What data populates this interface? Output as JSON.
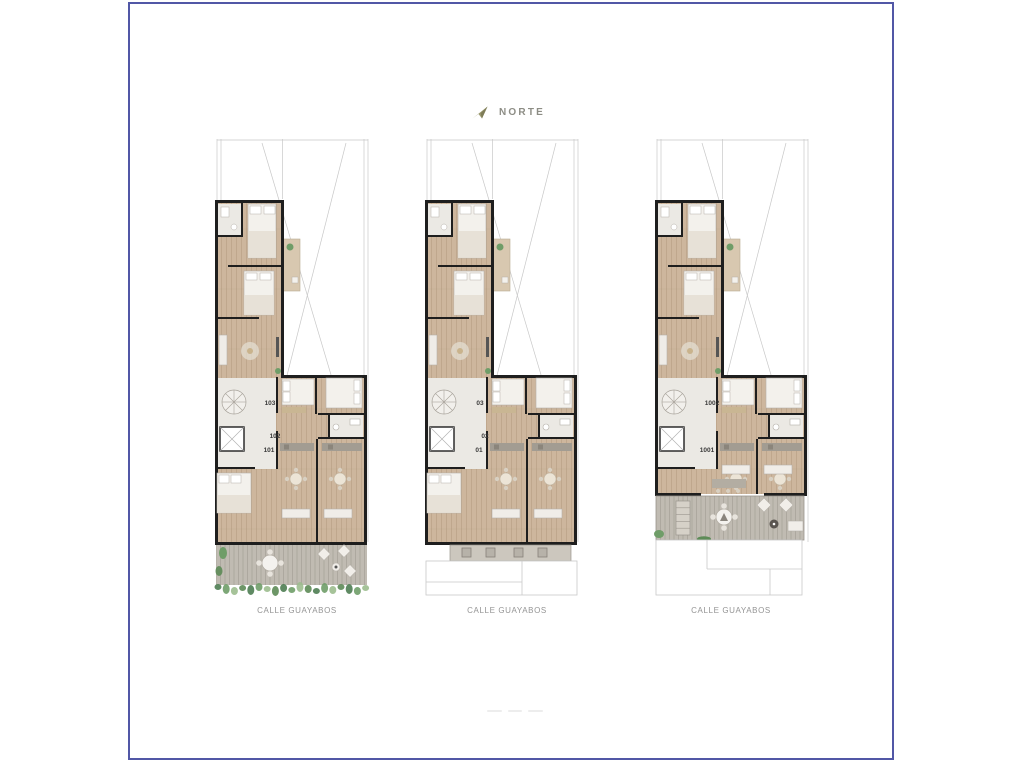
{
  "compass": {
    "label": "NORTE",
    "icon": "north-arrow-icon"
  },
  "plans": [
    {
      "id": "floor-plan-1",
      "street_label": "CALLE GUAYABOS",
      "units": [
        {
          "label": "103"
        },
        {
          "label": "102"
        },
        {
          "label": "101"
        }
      ]
    },
    {
      "id": "floor-plan-2",
      "street_label": "CALLE GUAYABOS",
      "units": [
        {
          "label": "03"
        },
        {
          "label": "02"
        },
        {
          "label": "01"
        }
      ]
    },
    {
      "id": "floor-plan-3",
      "street_label": "CALLE GUAYABOS",
      "units": [
        {
          "label": "1002"
        },
        {
          "label": "1001"
        }
      ]
    }
  ],
  "colors": {
    "frame_border": "#5157a6",
    "compass_icon": "#9b996f",
    "compass_text": "#8d8d85",
    "wall": "#1e1e1e",
    "wood_floor": "#cdb69d",
    "light_floor": "#ebe9e4",
    "terrace_deck": "#c0bbb2",
    "balcony_floor": "#d8c8b0",
    "greenery": "#6f9d68",
    "property_line": "#c8c8c8",
    "street_text": "#949494",
    "unit_text": "#3a3a3a"
  }
}
